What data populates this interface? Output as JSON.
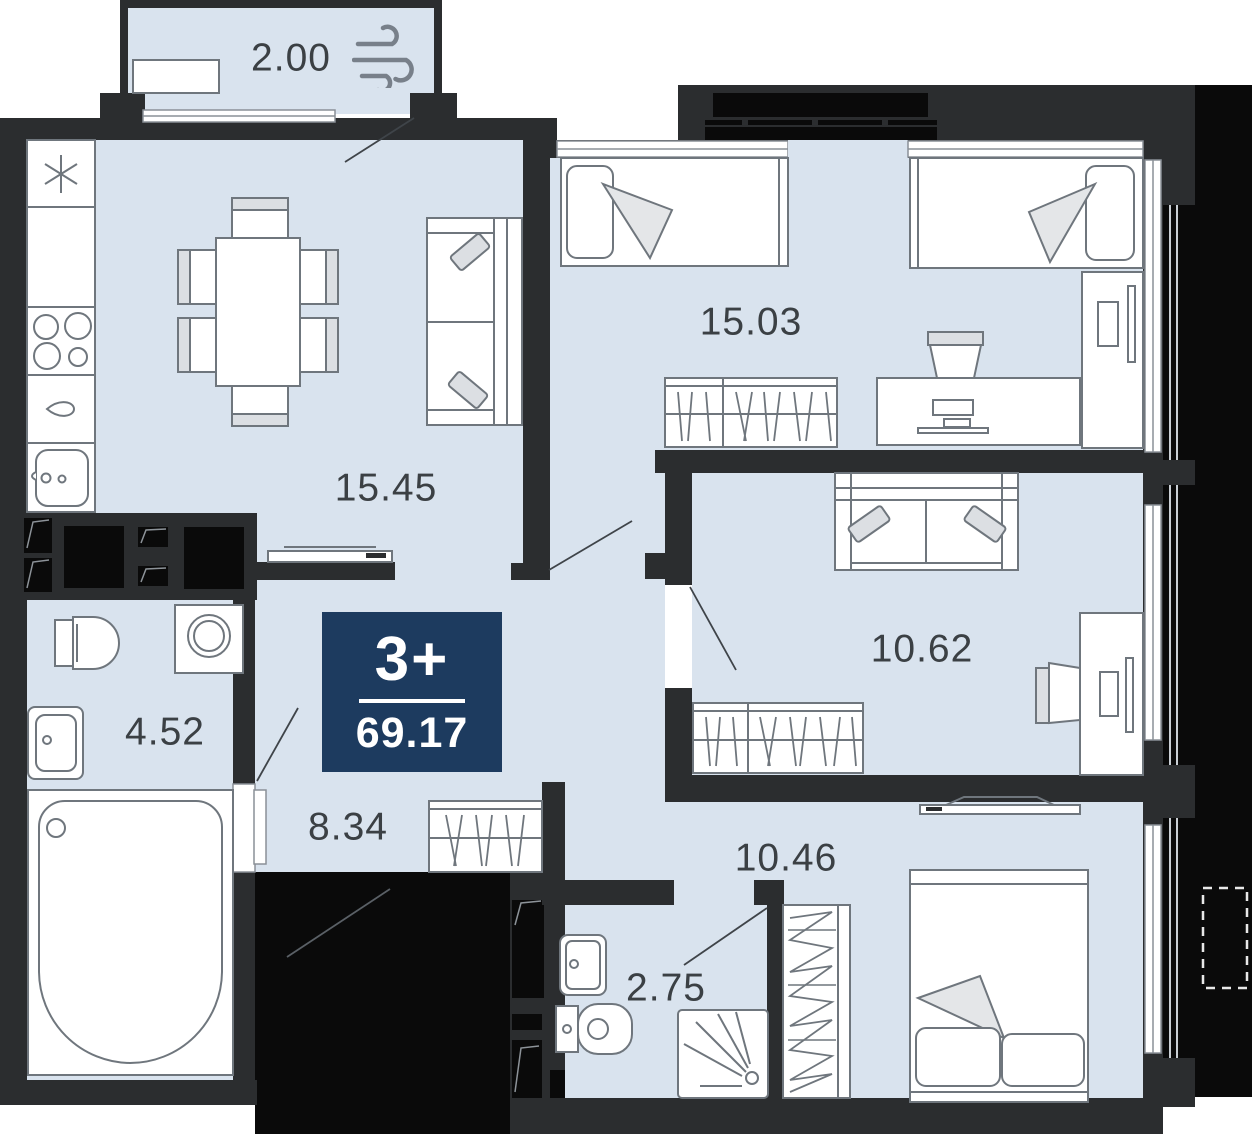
{
  "plan": {
    "badge": {
      "rooms_label": "3+",
      "area_label": "69.17"
    },
    "rooms": [
      {
        "id": "balcony",
        "area_label": "2.00"
      },
      {
        "id": "kitchen-living-room",
        "area_label": "15.45"
      },
      {
        "id": "bedroom-top",
        "area_label": "15.03"
      },
      {
        "id": "bedroom-middle",
        "area_label": "10.62"
      },
      {
        "id": "bathroom-main",
        "area_label": "4.52"
      },
      {
        "id": "hallway",
        "area_label": "8.34"
      },
      {
        "id": "bedroom-bottom",
        "area_label": "10.46"
      },
      {
        "id": "bathroom-small",
        "area_label": "2.75"
      }
    ],
    "icons": [
      {
        "name": "wind-icon",
        "meaning": "balcony ventilation"
      }
    ],
    "colors": {
      "room_fill": "#d9e3ee",
      "wall": "#2b2d2f",
      "silhouette": "#0a0a0a",
      "badge_bg": "#1d3b5f",
      "badge_text": "#ffffff",
      "furniture_stroke": "#6f767d",
      "cushion_fill": "#dcdfe3",
      "label_text": "#3b4044",
      "window_white": "#ffffff"
    }
  }
}
